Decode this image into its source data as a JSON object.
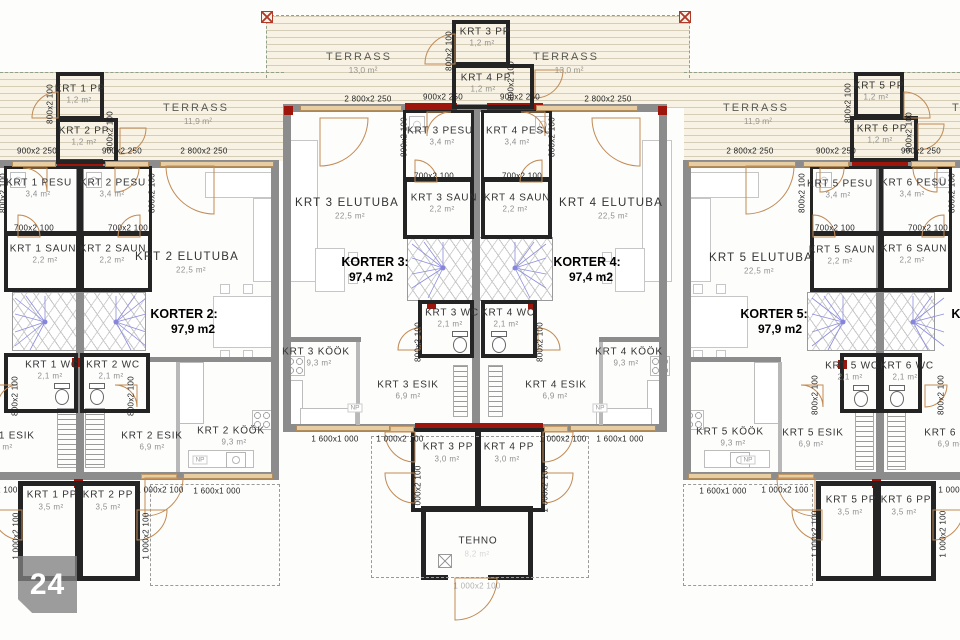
{
  "watermark": {
    "number": "24"
  },
  "fixtures": {
    "np": "NP"
  },
  "dims": {
    "w900": "900x2 250",
    "w2800": "2 800x2 250",
    "d800": "800x2 100",
    "d700": "700x2 100",
    "d1000": "1 000x2 100",
    "w1600": "1 600x1 000"
  },
  "terraces": [
    {
      "label": "TERRASS",
      "area": "11,9 m²"
    },
    {
      "label": "TERRASS",
      "area": "13,0 m²"
    },
    {
      "label": "TERRASS",
      "area": "13,0 m²"
    },
    {
      "label": "TERRASS",
      "area": "11,9 m²"
    },
    {
      "label": "TERRASS",
      "area": "11,9 m²"
    }
  ],
  "korters": [
    {
      "title": "KORTER 2:",
      "area": "97,9 m2"
    },
    {
      "title": "KORTER 3:",
      "area": "97,4 m2"
    },
    {
      "title": "KORTER 4:",
      "area": "97,4 m2"
    },
    {
      "title": "KORTER 5:",
      "area": "97,9 m2"
    },
    {
      "title": "KORTER 6:",
      "area": "97,9 m2"
    }
  ],
  "rooms": [
    {
      "label": "KRT 1 PP",
      "area": "1,2 m²"
    },
    {
      "label": "KRT 2 PP",
      "area": "1,2 m²"
    },
    {
      "label": "KRT 3 PP",
      "area": "1,2 m²"
    },
    {
      "label": "KRT 4 PP",
      "area": "1,2 m²"
    },
    {
      "label": "KRT 5 PP",
      "area": "1,2 m²"
    },
    {
      "label": "KRT 6 PP",
      "area": "1,2 m²"
    },
    {
      "label": "KRT 1 PESU",
      "area": "3,4 m²"
    },
    {
      "label": "KRT 2 PESU",
      "area": "3,4 m²"
    },
    {
      "label": "KRT 3 PESU",
      "area": "3,4 m²"
    },
    {
      "label": "KRT 4 PESU",
      "area": "3,4 m²"
    },
    {
      "label": "KRT 5 PESU",
      "area": "3,4 m²"
    },
    {
      "label": "KRT 6 PESU",
      "area": "3,4 m²"
    },
    {
      "label": "KRT 1 SAUN",
      "area": "2,2 m²"
    },
    {
      "label": "KRT 2 SAUN",
      "area": "2,2 m²"
    },
    {
      "label": "KRT 3 SAUN",
      "area": "2,2 m²"
    },
    {
      "label": "KRT 4 SAUN",
      "area": "2,2 m²"
    },
    {
      "label": "KRT 5 SAUN",
      "area": "2,2 m²"
    },
    {
      "label": "KRT 6 SAUN",
      "area": "2,2 m²"
    },
    {
      "label": "KRT 2 ELUTUBA",
      "area": "22,5 m²"
    },
    {
      "label": "KRT 3 ELUTUBA",
      "area": "22,5 m²"
    },
    {
      "label": "KRT 4 ELUTUBA",
      "area": "22,5 m²"
    },
    {
      "label": "KRT 5 ELUTUBA",
      "area": "22,5 m²"
    },
    {
      "label": "KRT 1 WC",
      "area": "2,1 m²"
    },
    {
      "label": "KRT 2 WC",
      "area": "2,1 m²"
    },
    {
      "label": "KRT 3 WC",
      "area": "2,1 m²"
    },
    {
      "label": "KRT 4 WC",
      "area": "2,1 m²"
    },
    {
      "label": "KRT 5 WC",
      "area": "2,1 m²"
    },
    {
      "label": "KRT 6 WC",
      "area": "2,1 m²"
    },
    {
      "label": "KRT 1 ESIK",
      "area": "6,9 m²"
    },
    {
      "label": "KRT 2 ESIK",
      "area": "6,9 m²"
    },
    {
      "label": "KRT 3 ESIK",
      "area": "6,9 m²"
    },
    {
      "label": "KRT 4 ESIK",
      "area": "6,9 m²"
    },
    {
      "label": "KRT 5 ESIK",
      "area": "6,9 m²"
    },
    {
      "label": "KRT 6 ESIK",
      "area": "6,9 m²"
    },
    {
      "label": "KRT 2 KÖÖK",
      "area": "9,3 m²"
    },
    {
      "label": "KRT 3 KÖÖK",
      "area": "9,3 m²"
    },
    {
      "label": "KRT 4 KÖÖK",
      "area": "9,3 m²"
    },
    {
      "label": "KRT 5 KÖÖK",
      "area": "9,3 m²"
    },
    {
      "label": "KRT 1 PP",
      "area": "3,5 m²"
    },
    {
      "label": "KRT 2 PP",
      "area": "3,5 m²"
    },
    {
      "label": "KRT 3 PP",
      "area": "3,0 m²"
    },
    {
      "label": "KRT 4 PP",
      "area": "3,0 m²"
    },
    {
      "label": "KRT 5 PP",
      "area": "3,5 m²"
    },
    {
      "label": "KRT 6 PP",
      "area": "3,5 m²"
    },
    {
      "label": "TEHNO",
      "area": "8,2 m²"
    }
  ]
}
